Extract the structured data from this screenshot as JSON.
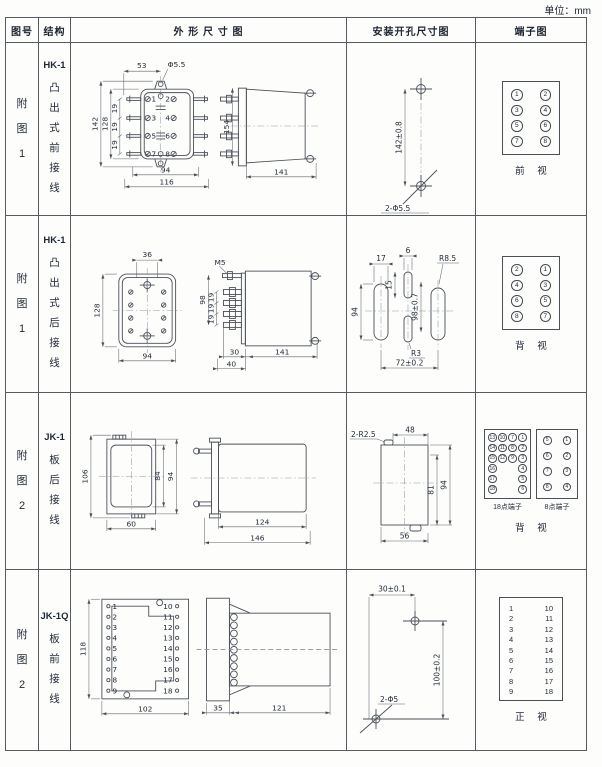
{
  "unit": "单位：mm",
  "header": {
    "fig": "图号",
    "structure": "结构",
    "outline": "外 形 尺 寸 图",
    "install": "安装开孔尺寸图",
    "terminal": "端子图"
  },
  "rows": [
    {
      "fig": "附\n图\n1",
      "model": "HK-1",
      "structure": "凸\n出\n式\n前\n接\n线",
      "outline": {
        "d53": "53",
        "hole": "Φ5.5",
        "d142": "142",
        "d128": "128",
        "p1": "19",
        "p2": "19",
        "p3": "19",
        "d94": "94",
        "d116": "116",
        "d154": "154",
        "d141": "141",
        "pins": [
          "1",
          "2",
          "3",
          "4",
          "5",
          "6",
          "7",
          "8"
        ]
      },
      "install": {
        "d142": "142±0.8",
        "holes": "2-Φ5.5"
      },
      "terminal": {
        "cells": [
          [
            "1",
            "2"
          ],
          [
            "3",
            "4"
          ],
          [
            "5",
            "6"
          ],
          [
            "7",
            "8"
          ]
        ],
        "view": "前 视"
      }
    },
    {
      "fig": "附\n图\n1",
      "model": "HK-1",
      "structure": "凸\n出\n式\n后\n接\n线",
      "outline": {
        "d36": "36",
        "d128": "128",
        "d94": "94",
        "m5": "M5",
        "d98": "98",
        "p1": "19",
        "p2": "19",
        "p3": "19",
        "d30": "30",
        "d40": "40",
        "d141": "141"
      },
      "install": {
        "d17": "17",
        "d6": "6",
        "d15": "15",
        "d94": "94",
        "d98": "98±0.7",
        "r85": "R8.5",
        "r3": "R3",
        "d72": "72±0.2"
      },
      "terminal": {
        "cells": [
          [
            "2",
            "1"
          ],
          [
            "4",
            "3"
          ],
          [
            "6",
            "5"
          ],
          [
            "8",
            "7"
          ]
        ],
        "view": "背 视"
      }
    },
    {
      "fig": "附\n图\n2",
      "model": "JK-1",
      "structure": "板\n后\n接\n线",
      "outline": {
        "d106": "106",
        "d84": "84",
        "d94": "94",
        "d60": "60",
        "d124": "124",
        "d146": "146"
      },
      "install": {
        "r25": "2-R2.5",
        "d48": "48",
        "d81": "81",
        "d94": "94",
        "d56": "56"
      },
      "terminal": {
        "grid18": [
          [
            "13",
            "10",
            "7",
            "1"
          ],
          [
            "14",
            "11",
            "8",
            "2"
          ],
          [
            "15",
            "12",
            "9",
            "3"
          ],
          [
            "16",
            "",
            "",
            "4"
          ],
          [
            "17",
            "",
            "",
            "5"
          ],
          [
            "18",
            "",
            "",
            "6"
          ]
        ],
        "grid8": [
          [
            "5",
            "1"
          ],
          [
            "6",
            "2"
          ],
          [
            "7",
            "3"
          ],
          [
            "8",
            "4"
          ]
        ],
        "label18": "18点端子",
        "label8": "8点端子",
        "view": "背 视"
      }
    },
    {
      "fig": "附\n图\n2",
      "model": "JK-1Q",
      "structure": "板\n前\n接\n线",
      "outline": {
        "d118": "118",
        "d102": "102",
        "d35": "35",
        "d121": "121",
        "pins_left": [
          "1",
          "2",
          "3",
          "4",
          "5",
          "6",
          "7",
          "8",
          "9"
        ],
        "pins_right": [
          "10",
          "11",
          "12",
          "13",
          "14",
          "15",
          "16",
          "17",
          "18"
        ]
      },
      "install": {
        "d30": "30±0.1",
        "d100": "100±0.2",
        "holes": "2-Φ5"
      },
      "terminal": {
        "left": "1\n2\n3\n4\n5\n6\n7\n8\n9",
        "right": "10\n11\n12\n13\n14\n15\n16\n17\n18",
        "view": "正 视"
      }
    }
  ]
}
